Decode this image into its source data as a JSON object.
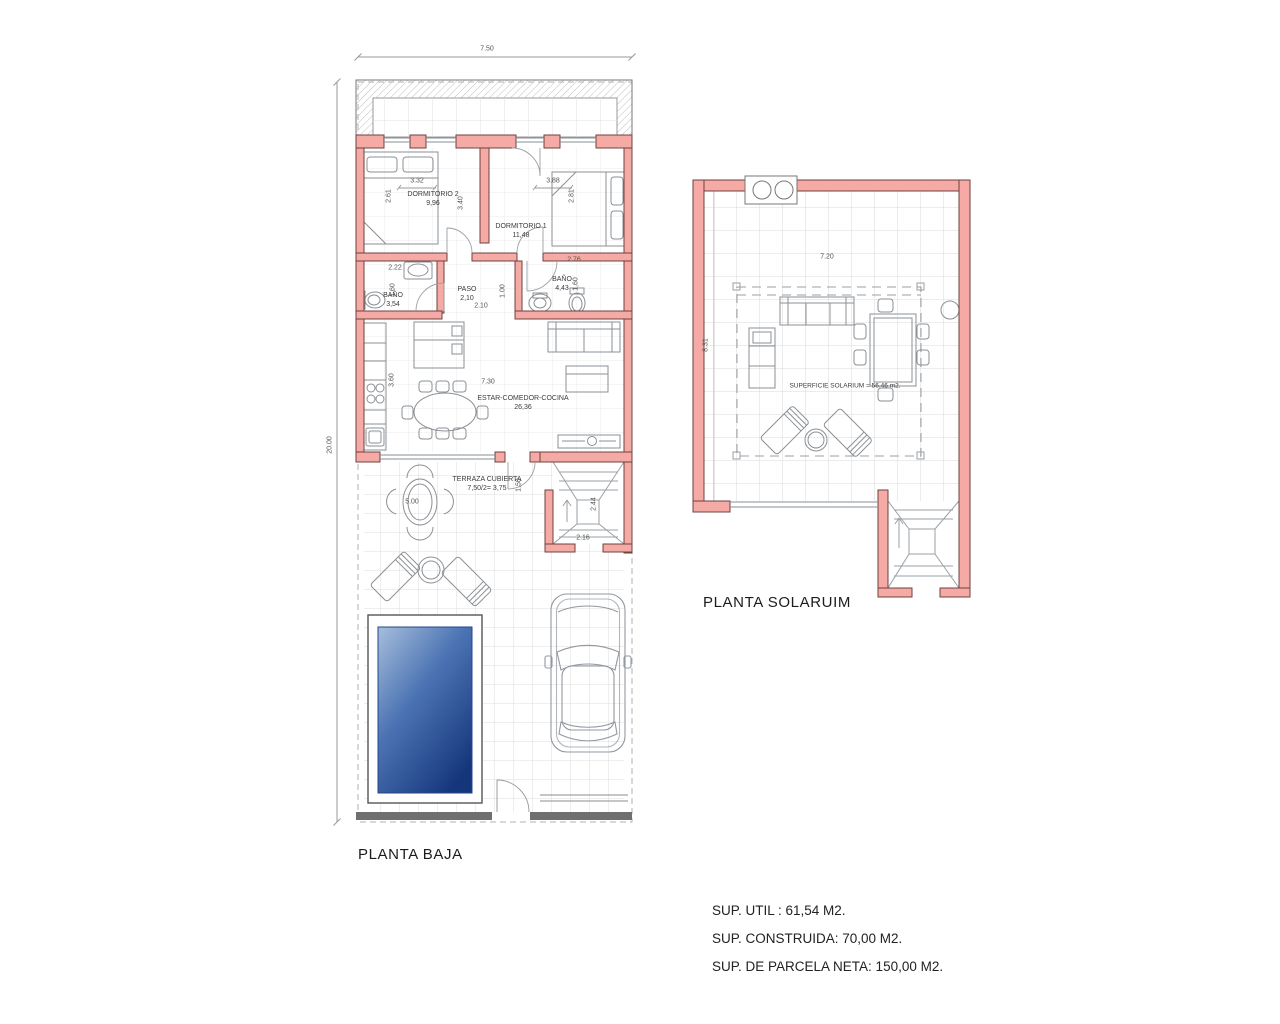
{
  "ground_floor": {
    "label": "PLANTA BAJA",
    "rooms": [
      {
        "name": "DORMITORIO 2",
        "area": "9,96"
      },
      {
        "name": "DORMITORIO 1",
        "area": "11,48"
      },
      {
        "name": "BAÑO",
        "area": "3,54"
      },
      {
        "name": "PASO",
        "area": "2,10"
      },
      {
        "name": "BAÑO",
        "area": "4,43"
      },
      {
        "name": "ESTAR-COMEDOR-COCINA",
        "area": "26,36"
      },
      {
        "name": "TERRAZA CUBIERTA",
        "area": "7,50/2= 3,75"
      }
    ],
    "dims": [
      "7.50",
      "20.00",
      "3.32",
      "2.61",
      "3.40",
      "3.88",
      "2.81",
      "2.22",
      "1.60",
      "1.00",
      "2.10",
      "2.76",
      "1,60",
      "3.60",
      "7.30",
      "1,50",
      "5.00",
      "2.44",
      "2.16"
    ]
  },
  "solarium": {
    "label": "PLANTA SOLARUIM",
    "note": "SUPERFICIE SOLARIUM = 56.46 m2.",
    "dims": [
      "7.20",
      "8.31"
    ]
  },
  "summary": [
    "SUP. UTIL : 61,54 M2.",
    "SUP. CONSTRUIDA: 70,00 M2.",
    "SUP. DE PARCELA NETA: 150,00 M2."
  ],
  "colors": {
    "wall_fill": "#f5aaa5",
    "wall_stroke": "#6e4340",
    "pool_light": "#a6bedb",
    "pool_mid": "#4c74b4",
    "pool_dark": "#16367c"
  }
}
